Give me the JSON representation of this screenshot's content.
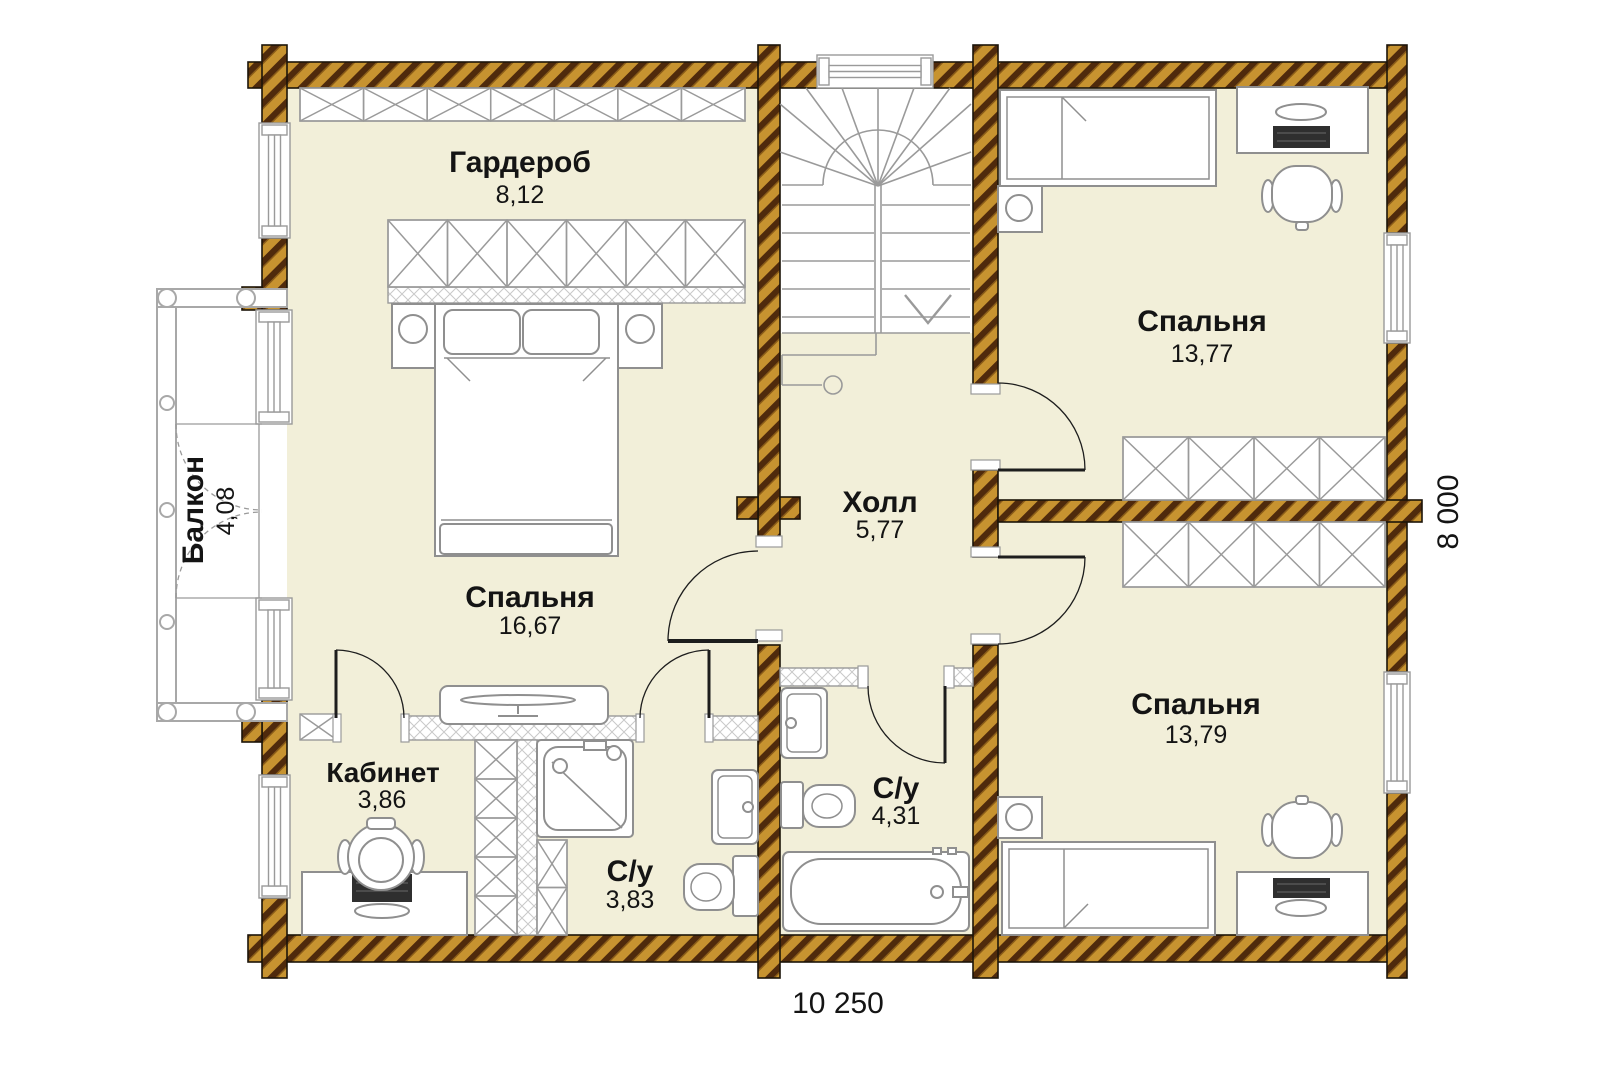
{
  "plan": {
    "rooms": {
      "garderob": {
        "name": "Гардероб",
        "area": "8,12"
      },
      "bedroom_master": {
        "name": "Спальня",
        "area": "16,67"
      },
      "balcony": {
        "name": "Балкон",
        "area": "4,08"
      },
      "kabinet": {
        "name": "Кабинет",
        "area": "3,86"
      },
      "bathroom_small": {
        "name": "С/у",
        "area": "3,83"
      },
      "hall": {
        "name": "Холл",
        "area": "5,77"
      },
      "bathroom_big": {
        "name": "С/у",
        "area": "4,31"
      },
      "bedroom_top": {
        "name": "Спальня",
        "area": "13,77"
      },
      "bedroom_bottom": {
        "name": "Спальня",
        "area": "13,79"
      }
    },
    "dimensions": {
      "width": "10 250",
      "height": "8 000"
    },
    "colors": {
      "floor": "#f2efd9",
      "wood": "#c79330",
      "wood_dark": "#4f2a0c",
      "line": "#8f8f8f"
    }
  }
}
